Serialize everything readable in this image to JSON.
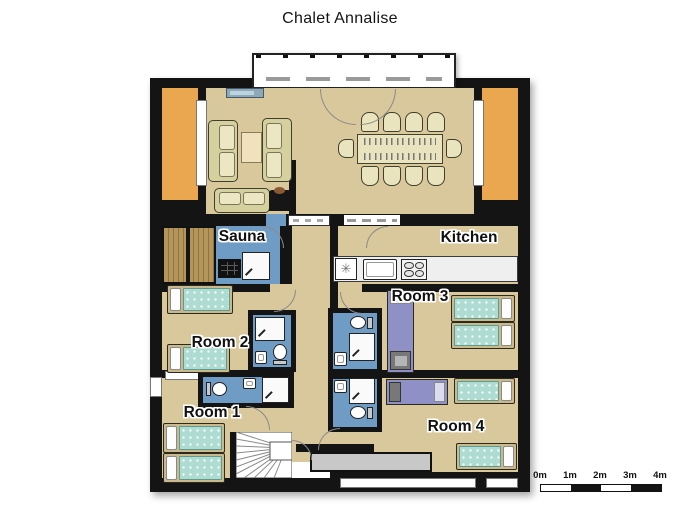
{
  "title": "Chalet Annalise",
  "rooms": {
    "sauna": "Sauna",
    "kitchen": "Kitchen",
    "room1": "Room 1",
    "room2": "Room 2",
    "room3": "Room 3",
    "room4": "Room 4"
  },
  "scale_bar": {
    "labels": [
      "0m",
      "1m",
      "2m",
      "3m",
      "4m"
    ]
  },
  "icons": {
    "fridge_symbol": "✳"
  },
  "colors": {
    "wall": "#141414",
    "floor": "#d8c89b",
    "terrace": "#eaa750",
    "bathroom_floor": "#6f9cc5",
    "bed_linen": "#aedcd2",
    "bunk_bed": "#8f90c6",
    "sofa": "#e9e4bd",
    "sauna_wood": "#b5965a",
    "storage": "#c8c8c8"
  }
}
